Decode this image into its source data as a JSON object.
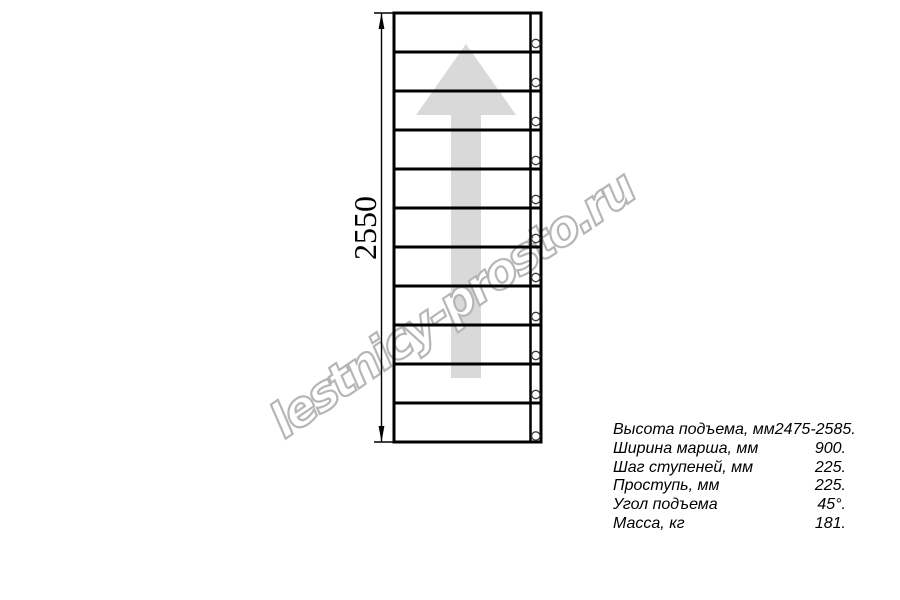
{
  "drawing": {
    "title_role": "stair-flight-plan-view",
    "dimension_label": "2550",
    "watermark_text": "lestnicy-prosto.ru",
    "step_panels": 11,
    "bolt_count": 11,
    "colors": {
      "line": "#000000",
      "arrow": "#d9d9d9",
      "watermark_outline": "#b6b6b6",
      "watermark_fill": "#ffffff",
      "bolt_outline": "#3a3a3a"
    }
  },
  "specs": {
    "rows": [
      {
        "label": "Высота подъема, мм",
        "value": "2475-2585."
      },
      {
        "label": "Ширина марша, мм",
        "value": "900."
      },
      {
        "label": "Шаг ступеней, мм",
        "value": "225."
      },
      {
        "label": "Проступь, мм",
        "value": "225."
      },
      {
        "label": "Угол подъема",
        "value": "45°."
      },
      {
        "label": "Масса, кг",
        "value": "181."
      }
    ]
  }
}
